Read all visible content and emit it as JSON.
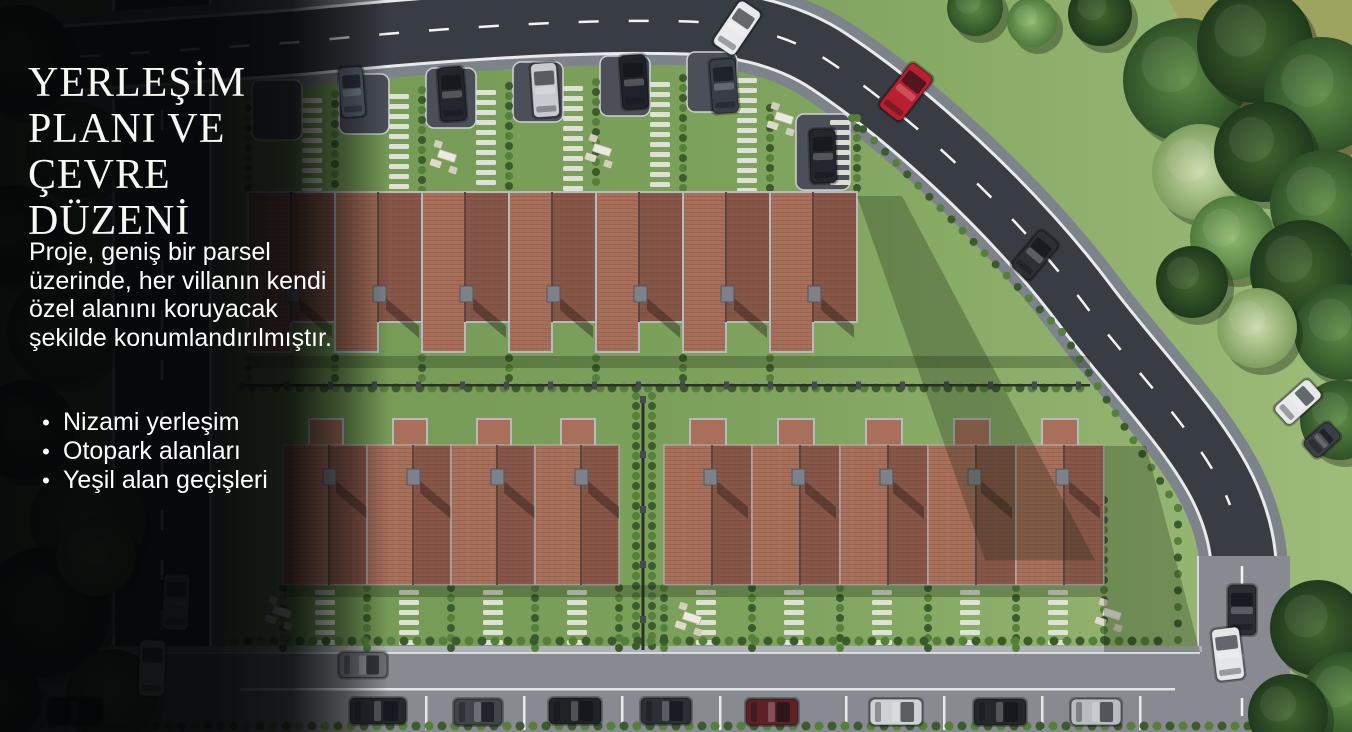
{
  "panel": {
    "title_lines": [
      "YERLEŞİM",
      "PLANI VE ÇEVRE",
      "DÜZENİ"
    ],
    "paragraph": "Proje, geniş bir parsel üzerinde, her villanın kendi özel alanını koruyacak şekilde konumlandırılmıştır.",
    "bullet_glyph": "•",
    "bullets": [
      "Nizami yerleşim",
      "Otopark alanları",
      "Yeşil alan geçişleri"
    ]
  },
  "palette": {
    "text": "#ffffff",
    "overlay": "#030406",
    "lawn_left": "#6d9450",
    "lawn_right": "#9dbc79",
    "olive_field": "#9da45f",
    "asphalt": "#383d44",
    "curb": "#7d838b",
    "road_light": "#878a90",
    "roof_light": "#a8705a",
    "roof_dark": "#875849",
    "eaves": "#b5bac0",
    "hedge_a": "#3a5c2d",
    "hedge_b": "#54803c",
    "stone": "#e4e5dd",
    "marking": "#f2f3f4"
  },
  "scene": {
    "villa_rows": [
      {
        "name": "top-row",
        "kind": "top",
        "x0": 248,
        "unit_w": 87,
        "count": 7,
        "y_top": 192,
        "h_long": 160,
        "h_short": 130,
        "chimney_dy": 94
      },
      {
        "name": "bottom-row-a",
        "kind": "bottom",
        "x0": 283,
        "unit_w": 84,
        "count": 4,
        "y_top": 445,
        "h": 140,
        "wing_w": 34,
        "wing_h": 26,
        "chimney_dy": 24
      },
      {
        "name": "bottom-row-b",
        "kind": "bottom",
        "x0": 664,
        "unit_w": 88,
        "count": 5,
        "y_top": 445,
        "h": 140,
        "wing_w": 36,
        "wing_h": 26,
        "chimney_dy": 24
      }
    ],
    "driveway_pads": [
      {
        "x": 252,
        "y": 80,
        "w": 50,
        "h": 60
      },
      {
        "x": 339,
        "y": 74,
        "w": 50,
        "h": 60
      },
      {
        "x": 426,
        "y": 68,
        "w": 50,
        "h": 60
      },
      {
        "x": 513,
        "y": 62,
        "w": 50,
        "h": 60
      },
      {
        "x": 600,
        "y": 56,
        "w": 50,
        "h": 60
      },
      {
        "x": 687,
        "y": 52,
        "w": 50,
        "h": 60
      },
      {
        "x": 796,
        "y": 114,
        "w": 54,
        "h": 76
      }
    ],
    "stone_columns": [
      {
        "x": 312,
        "y0": 98,
        "y1": 188
      },
      {
        "x": 399,
        "y0": 94,
        "y1": 188
      },
      {
        "x": 486,
        "y0": 90,
        "y1": 188
      },
      {
        "x": 573,
        "y0": 86,
        "y1": 188
      },
      {
        "x": 660,
        "y0": 82,
        "y1": 188
      },
      {
        "x": 747,
        "y0": 78,
        "y1": 188
      },
      {
        "x": 840,
        "y0": 120,
        "y1": 188
      },
      {
        "x": 325,
        "y0": 590,
        "y1": 648
      },
      {
        "x": 409,
        "y0": 590,
        "y1": 648
      },
      {
        "x": 493,
        "y0": 590,
        "y1": 648
      },
      {
        "x": 577,
        "y0": 590,
        "y1": 648
      },
      {
        "x": 706,
        "y0": 590,
        "y1": 648
      },
      {
        "x": 794,
        "y0": 590,
        "y1": 648
      },
      {
        "x": 882,
        "y0": 590,
        "y1": 648
      },
      {
        "x": 970,
        "y0": 590,
        "y1": 648
      },
      {
        "x": 1058,
        "y0": 590,
        "y1": 648
      }
    ],
    "bush_columns": [
      {
        "x": 248,
        "y0": 98,
        "y1": 190
      },
      {
        "x": 335,
        "y0": 94,
        "y1": 190
      },
      {
        "x": 422,
        "y0": 90,
        "y1": 190
      },
      {
        "x": 509,
        "y0": 86,
        "y1": 190
      },
      {
        "x": 596,
        "y0": 82,
        "y1": 190
      },
      {
        "x": 683,
        "y0": 78,
        "y1": 190
      },
      {
        "x": 770,
        "y0": 108,
        "y1": 190
      },
      {
        "x": 857,
        "y0": 118,
        "y1": 195
      },
      {
        "x": 248,
        "y0": 358,
        "y1": 382
      },
      {
        "x": 335,
        "y0": 358,
        "y1": 382
      },
      {
        "x": 422,
        "y0": 358,
        "y1": 382
      },
      {
        "x": 509,
        "y0": 358,
        "y1": 382
      },
      {
        "x": 596,
        "y0": 358,
        "y1": 382
      },
      {
        "x": 683,
        "y0": 358,
        "y1": 382
      },
      {
        "x": 770,
        "y0": 358,
        "y1": 382
      },
      {
        "x": 283,
        "y0": 588,
        "y1": 648
      },
      {
        "x": 367,
        "y0": 588,
        "y1": 648
      },
      {
        "x": 451,
        "y0": 588,
        "y1": 648
      },
      {
        "x": 535,
        "y0": 588,
        "y1": 648
      },
      {
        "x": 619,
        "y0": 588,
        "y1": 648
      },
      {
        "x": 664,
        "y0": 588,
        "y1": 648
      },
      {
        "x": 752,
        "y0": 588,
        "y1": 648
      },
      {
        "x": 840,
        "y0": 588,
        "y1": 648
      },
      {
        "x": 928,
        "y0": 588,
        "y1": 648
      },
      {
        "x": 1016,
        "y0": 588,
        "y1": 648
      },
      {
        "x": 1104,
        "y0": 500,
        "y1": 648
      },
      {
        "x": 636,
        "y0": 396,
        "y1": 650
      },
      {
        "x": 652,
        "y0": 396,
        "y1": 650
      }
    ],
    "bush_rows": [
      {
        "y": 641,
        "x0": 235,
        "x1": 1168,
        "step": 13
      },
      {
        "y": 388,
        "x0": 240,
        "x1": 1090,
        "step": 12
      },
      {
        "y": 726,
        "x0": 0,
        "x1": 1280,
        "step": 13
      }
    ],
    "bush_paths": [
      {
        "step": 16,
        "pts": [
          [
            852,
            118
          ],
          [
            1062,
            332
          ],
          [
            1178,
            508
          ],
          [
            1178,
            640
          ]
        ]
      }
    ],
    "fences": [
      {
        "x0": 240,
        "x1": 1090,
        "y": 384,
        "post_step": 44
      },
      {
        "x0": 643,
        "x1": 643,
        "y": 396,
        "vertical_y1": 650,
        "post_step": 55
      }
    ],
    "shadows": [
      {
        "pts": [
          [
            857,
            196
          ],
          [
            902,
            196
          ],
          [
            1095,
            560
          ],
          [
            985,
            560
          ]
        ]
      },
      {
        "pts": [
          [
            1104,
            446
          ],
          [
            1146,
            446
          ],
          [
            1200,
            652
          ],
          [
            1104,
            652
          ]
        ]
      },
      {
        "pts": [
          [
            248,
            356
          ],
          [
            1090,
            356
          ],
          [
            1090,
            368
          ],
          [
            248,
            368
          ]
        ]
      },
      {
        "pts": [
          [
            283,
            585
          ],
          [
            1104,
            585
          ],
          [
            1104,
            597
          ],
          [
            283,
            597
          ]
        ]
      }
    ],
    "picnics": [
      {
        "x": 447,
        "y": 156
      },
      {
        "x": 602,
        "y": 150
      },
      {
        "x": 784,
        "y": 118
      },
      {
        "x": 282,
        "y": 612
      },
      {
        "x": 692,
        "y": 618
      },
      {
        "x": 1112,
        "y": 614
      }
    ],
    "trees": [
      {
        "x": 975,
        "y": 8,
        "r": 28,
        "t": "tm"
      },
      {
        "x": 1100,
        "y": 14,
        "r": 32,
        "t": "td"
      },
      {
        "x": 1032,
        "y": 22,
        "r": 25,
        "t": "tl"
      },
      {
        "x": 1185,
        "y": 80,
        "r": 62,
        "t": "tm"
      },
      {
        "x": 1255,
        "y": 45,
        "r": 58,
        "t": "td"
      },
      {
        "x": 1322,
        "y": 95,
        "r": 58,
        "t": "tm"
      },
      {
        "x": 1200,
        "y": 172,
        "r": 48,
        "t": "ts"
      },
      {
        "x": 1264,
        "y": 152,
        "r": 50,
        "t": "td"
      },
      {
        "x": 1325,
        "y": 205,
        "r": 55,
        "t": "tm"
      },
      {
        "x": 1232,
        "y": 238,
        "r": 42,
        "t": "tl"
      },
      {
        "x": 1302,
        "y": 272,
        "r": 52,
        "t": "td"
      },
      {
        "x": 1342,
        "y": 332,
        "r": 48,
        "t": "tm"
      },
      {
        "x": 1257,
        "y": 328,
        "r": 40,
        "t": "ts"
      },
      {
        "x": 1192,
        "y": 282,
        "r": 36,
        "t": "td"
      },
      {
        "x": 1340,
        "y": 420,
        "r": 40,
        "t": "tm"
      },
      {
        "x": 1318,
        "y": 628,
        "r": 48,
        "t": "td"
      },
      {
        "x": 1348,
        "y": 698,
        "r": 46,
        "t": "tm"
      },
      {
        "x": 1288,
        "y": 714,
        "r": 40,
        "t": "td"
      },
      {
        "x": 20,
        "y": 60,
        "r": 55,
        "t": "td"
      },
      {
        "x": 75,
        "y": 150,
        "r": 48,
        "t": "tm"
      },
      {
        "x": 15,
        "y": 235,
        "r": 50,
        "t": "td"
      },
      {
        "x": 62,
        "y": 330,
        "r": 55,
        "t": "tm"
      },
      {
        "x": 25,
        "y": 430,
        "r": 50,
        "t": "td"
      },
      {
        "x": 88,
        "y": 520,
        "r": 58,
        "t": "tm"
      },
      {
        "x": 45,
        "y": 612,
        "r": 65,
        "t": "td"
      },
      {
        "x": 112,
        "y": 695,
        "r": 46,
        "t": "tm"
      },
      {
        "x": 0,
        "y": 700,
        "r": 42,
        "t": "td"
      },
      {
        "x": 96,
        "y": 556,
        "r": 40,
        "t": "tl"
      }
    ],
    "cars": [
      {
        "n": "car-driveway-1",
        "x": 352,
        "y": 92,
        "w": 24,
        "h": 50,
        "r": -4,
        "c": "#5a6472"
      },
      {
        "n": "car-driveway-2",
        "x": 452,
        "y": 94,
        "w": 26,
        "h": 54,
        "r": -4,
        "c": "#23262c"
      },
      {
        "n": "car-driveway-3",
        "x": 545,
        "y": 90,
        "w": 26,
        "h": 54,
        "r": -4,
        "c": "#c7cad0"
      },
      {
        "n": "car-driveway-4",
        "x": 634,
        "y": 82,
        "w": 26,
        "h": 54,
        "r": -4,
        "c": "#1f2329"
      },
      {
        "n": "car-driveway-5",
        "x": 724,
        "y": 86,
        "w": 26,
        "h": 54,
        "r": -4,
        "c": "#383e47"
      },
      {
        "n": "car-driveway-6",
        "x": 823,
        "y": 156,
        "w": 26,
        "h": 54,
        "r": -2,
        "c": "#23262c"
      },
      {
        "n": "car-road-white",
        "x": 737,
        "y": 28,
        "w": 26,
        "h": 52,
        "r": 34,
        "c": "#e8eaec"
      },
      {
        "n": "car-road-red",
        "x": 906,
        "y": 92,
        "w": 28,
        "h": 56,
        "r": 38,
        "c": "#b91f2e"
      },
      {
        "n": "truck-road",
        "x": 1035,
        "y": 255,
        "w": 25,
        "h": 48,
        "r": 40,
        "c": "#2c3036"
      },
      {
        "n": "car-road-white-2",
        "x": 1298,
        "y": 402,
        "w": 24,
        "h": 46,
        "r": 48,
        "c": "#e6e8ea"
      },
      {
        "n": "trailer",
        "x": 1322,
        "y": 440,
        "w": 22,
        "h": 34,
        "r": 48,
        "c": "#3a3f46"
      },
      {
        "n": "car-left-road-1",
        "x": 176,
        "y": 602,
        "w": 26,
        "h": 56,
        "r": 2,
        "c": "#9aa6b0"
      },
      {
        "n": "car-left-road-2",
        "x": 152,
        "y": 668,
        "w": 26,
        "h": 56,
        "r": 2,
        "c": "#dcdee0"
      },
      {
        "n": "suv-right-road",
        "x": 1242,
        "y": 610,
        "w": 28,
        "h": 50,
        "r": 0,
        "c": "#2a2e35"
      },
      {
        "n": "car-right-road",
        "x": 1228,
        "y": 654,
        "w": 28,
        "h": 52,
        "r": -7,
        "c": "#e4e6e8"
      },
      {
        "n": "car-parked-1",
        "x": 75,
        "y": 711,
        "w": 26,
        "h": 54,
        "r": 90,
        "c": "#23262b"
      },
      {
        "n": "car-curb",
        "x": 363,
        "y": 665,
        "w": 25,
        "h": 48,
        "r": 90,
        "c": "#6b7078"
      },
      {
        "n": "car-parked-2",
        "x": 378,
        "y": 711,
        "w": 26,
        "h": 56,
        "r": 90,
        "c": "#24272d"
      },
      {
        "n": "car-parked-3",
        "x": 478,
        "y": 712,
        "w": 26,
        "h": 48,
        "r": 90,
        "c": "#40454c"
      },
      {
        "n": "car-parked-4",
        "x": 575,
        "y": 711,
        "w": 26,
        "h": 52,
        "r": 90,
        "c": "#1f2227"
      },
      {
        "n": "car-parked-5",
        "x": 666,
        "y": 711,
        "w": 26,
        "h": 50,
        "r": 90,
        "c": "#2b2f36"
      },
      {
        "n": "car-parked-6",
        "x": 772,
        "y": 712,
        "w": 26,
        "h": 52,
        "r": 90,
        "c": "#5f2126"
      },
      {
        "n": "car-parked-7",
        "x": 896,
        "y": 712,
        "w": 26,
        "h": 52,
        "r": 90,
        "c": "#cfd2d5"
      },
      {
        "n": "car-parked-8",
        "x": 1000,
        "y": 712,
        "w": 26,
        "h": 52,
        "r": 90,
        "c": "#24272c"
      },
      {
        "n": "car-parked-9",
        "x": 1096,
        "y": 712,
        "w": 26,
        "h": 50,
        "r": 90,
        "c": "#b8bcc1"
      }
    ],
    "parking_lines": [
      425,
      523,
      621,
      719,
      845,
      943,
      1041,
      1139
    ],
    "lane_line": {
      "x0": 240,
      "x1": 1175,
      "y": 688
    }
  }
}
